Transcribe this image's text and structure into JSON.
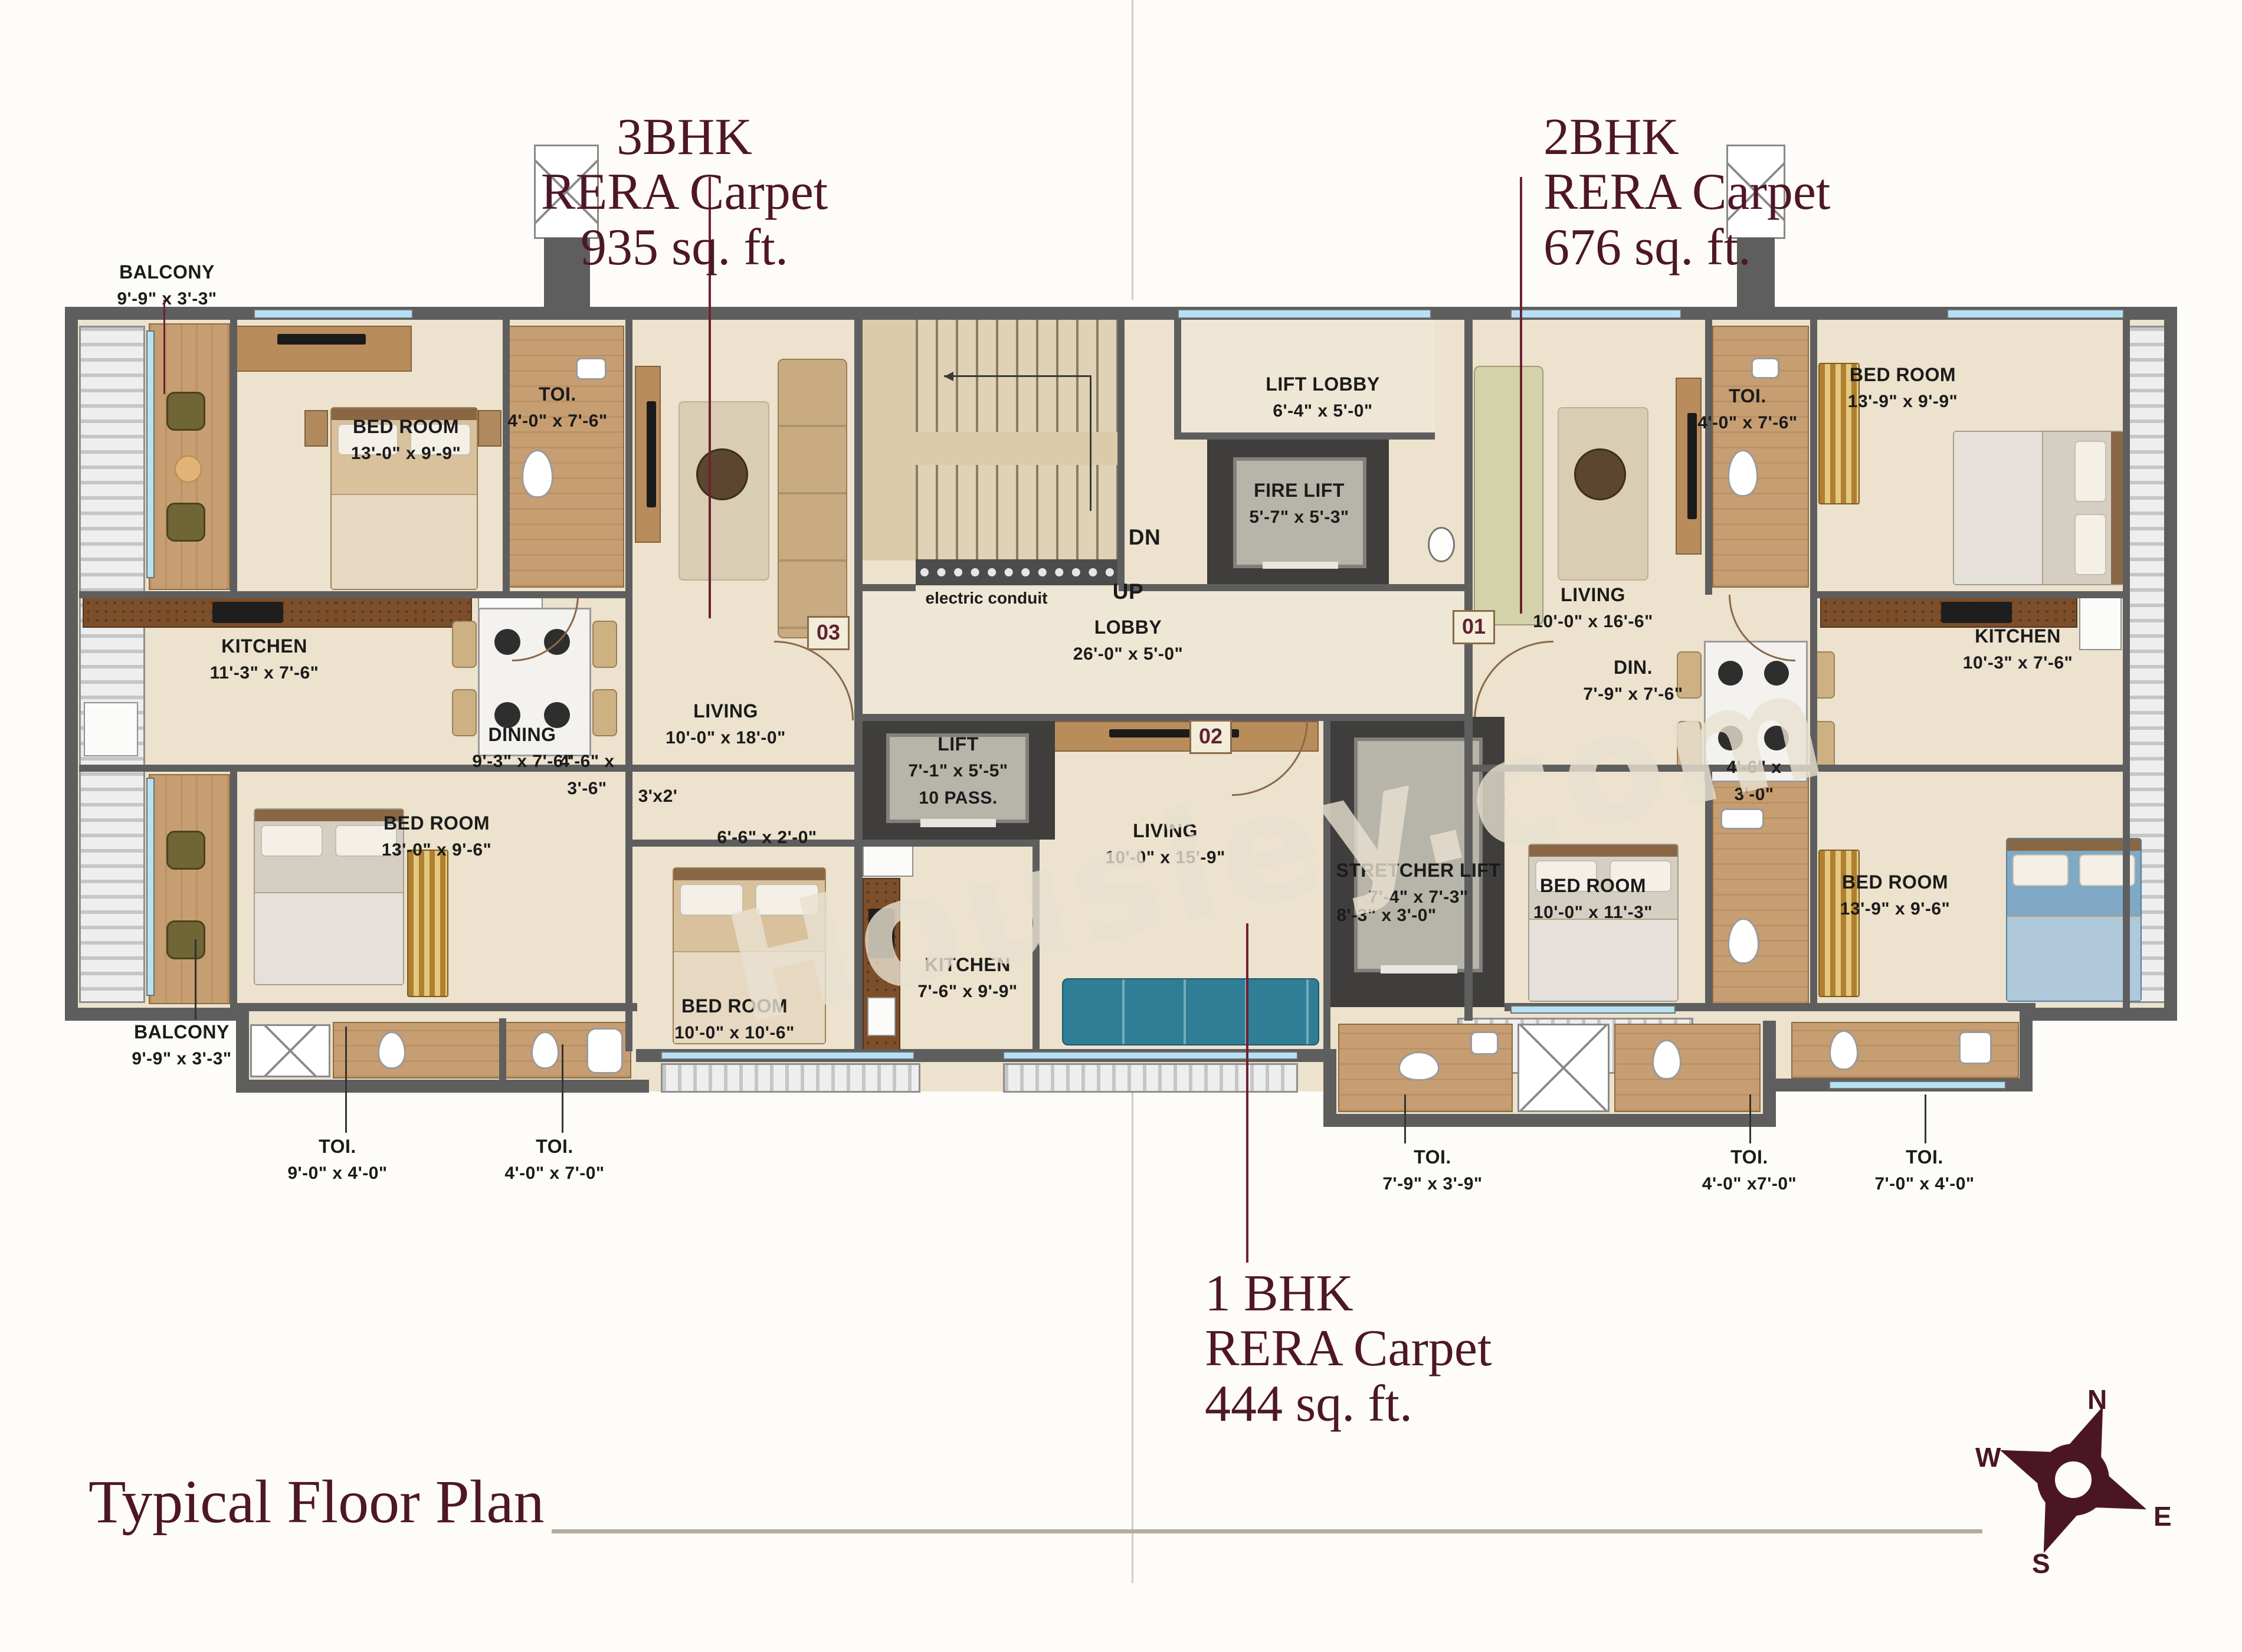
{
  "title": "Typical Floor Plan",
  "watermark": "Housiey.com",
  "unit_labels": {
    "bhk3": {
      "l1": "3BHK",
      "l2": "RERA Carpet",
      "l3": "935 sq. ft."
    },
    "bhk2": {
      "l1": "2BHK",
      "l2": "RERA Carpet",
      "l3": "676 sq. ft."
    },
    "bhk1": {
      "l1": "1 BHK",
      "l2": "RERA Carpet",
      "l3": "444 sq. ft."
    }
  },
  "unit_numbers": {
    "u03": "03",
    "u01": "01",
    "u02": "02"
  },
  "compass": {
    "n": "N",
    "e": "E",
    "s": "S",
    "w": "W"
  },
  "core": {
    "lift_lobby": {
      "name": "LIFT LOBBY",
      "dims": "6'-4\" x 5'-0\""
    },
    "fire_lift": {
      "name": "FIRE LIFT",
      "dims": "5'-7\" x 5'-3\""
    },
    "lobby": {
      "name": "LOBBY",
      "dims": "26'-0\" x 5'-0\""
    },
    "lift": {
      "name": "LIFT",
      "dims": "7'-1\" x 5'-5\"",
      "capacity": "10 PASS."
    },
    "stretcher_lift": {
      "name": "STRETCHER LIFT",
      "dims": "7'-4\" x 7'-3\""
    },
    "dn": "DN",
    "up": "UP",
    "electric_conduit": "electric conduit"
  },
  "rooms": {
    "balcony_tl": {
      "name": "BALCONY",
      "dims": "9'-9\" x 3'-3\""
    },
    "bed_tl": {
      "name": "BED ROOM",
      "dims": "13'-0\" x 9'-9\""
    },
    "toi_tl": {
      "name": "TOI.",
      "dims": "4'-0\" x 7'-6\""
    },
    "kitchen_l": {
      "name": "KITCHEN",
      "dims": "11'-3\" x 7'-6\""
    },
    "dining_l": {
      "name": "DINING",
      "dims": "9'-3\" x 7'-6\""
    },
    "living_l": {
      "name": "LIVING",
      "dims": "10'-0\" x 18'-0\""
    },
    "bed_bl": {
      "name": "BED ROOM",
      "dims": "13'-0\" x 9'-6\""
    },
    "balcony_bl": {
      "name": "BALCONY",
      "dims": "9'-9\" x 3'-3\""
    },
    "toi_bl1": {
      "name": "TOI.",
      "dims": "9'-0\" x 4'-0\""
    },
    "toi_bl2": {
      "name": "TOI.",
      "dims": "4'-0\" x 7'-0\""
    },
    "bed_c": {
      "name": "BED ROOM",
      "dims": "10'-0\" x 10'-6\""
    },
    "kitchen_c": {
      "name": "KITCHEN",
      "dims": "7'-6\" x 9'-9\""
    },
    "living_c": {
      "name": "LIVING",
      "dims": "10'-0\" x 15'-9\""
    },
    "toi_cr": {
      "name": "TOI.",
      "dims": "7'-9\" x 3'-9\""
    },
    "living_r": {
      "name": "LIVING",
      "dims": "10'-0\" x 16'-6\""
    },
    "din_r": {
      "name": "DIN.",
      "dims": "7'-9\" x 7'-6\""
    },
    "toi_tr": {
      "name": "TOI.",
      "dims": "4'-0\" x 7'-6\""
    },
    "bed_tr": {
      "name": "BED ROOM",
      "dims": "13'-9\" x 9'-9\""
    },
    "kitchen_r": {
      "name": "KITCHEN",
      "dims": "10'-3\" x 7'-6\""
    },
    "bed_br1": {
      "name": "BED ROOM",
      "dims": "10'-0\" x 11'-3\""
    },
    "bed_br2": {
      "name": "BED ROOM",
      "dims": "13'-9\" x 9'-6\""
    },
    "toi_br1": {
      "name": "TOI.",
      "dims": "4'-0\" x7'-0\""
    },
    "toi_br2": {
      "name": "TOI.",
      "dims": "7'-0\" x 4'-0\""
    }
  },
  "notes": {
    "pass_l": {
      "l1": "4'-6\" x",
      "l2": "3'-6\""
    },
    "niche_l": "3'x2'",
    "shelf_l": "6'-6\" x 2'-0\"",
    "pass_c": "8'-3\" x 3'-0\"",
    "pass_r": {
      "l1": "4'-6\" x",
      "l2": "3'-0\""
    }
  },
  "colors": {
    "accent_maroon": "#4e1726",
    "wall_gray": "#5e5e5e",
    "floor_cream": "#ece2cd",
    "window_blue": "#b7e1f3",
    "wood_tan": "#c79e71"
  }
}
